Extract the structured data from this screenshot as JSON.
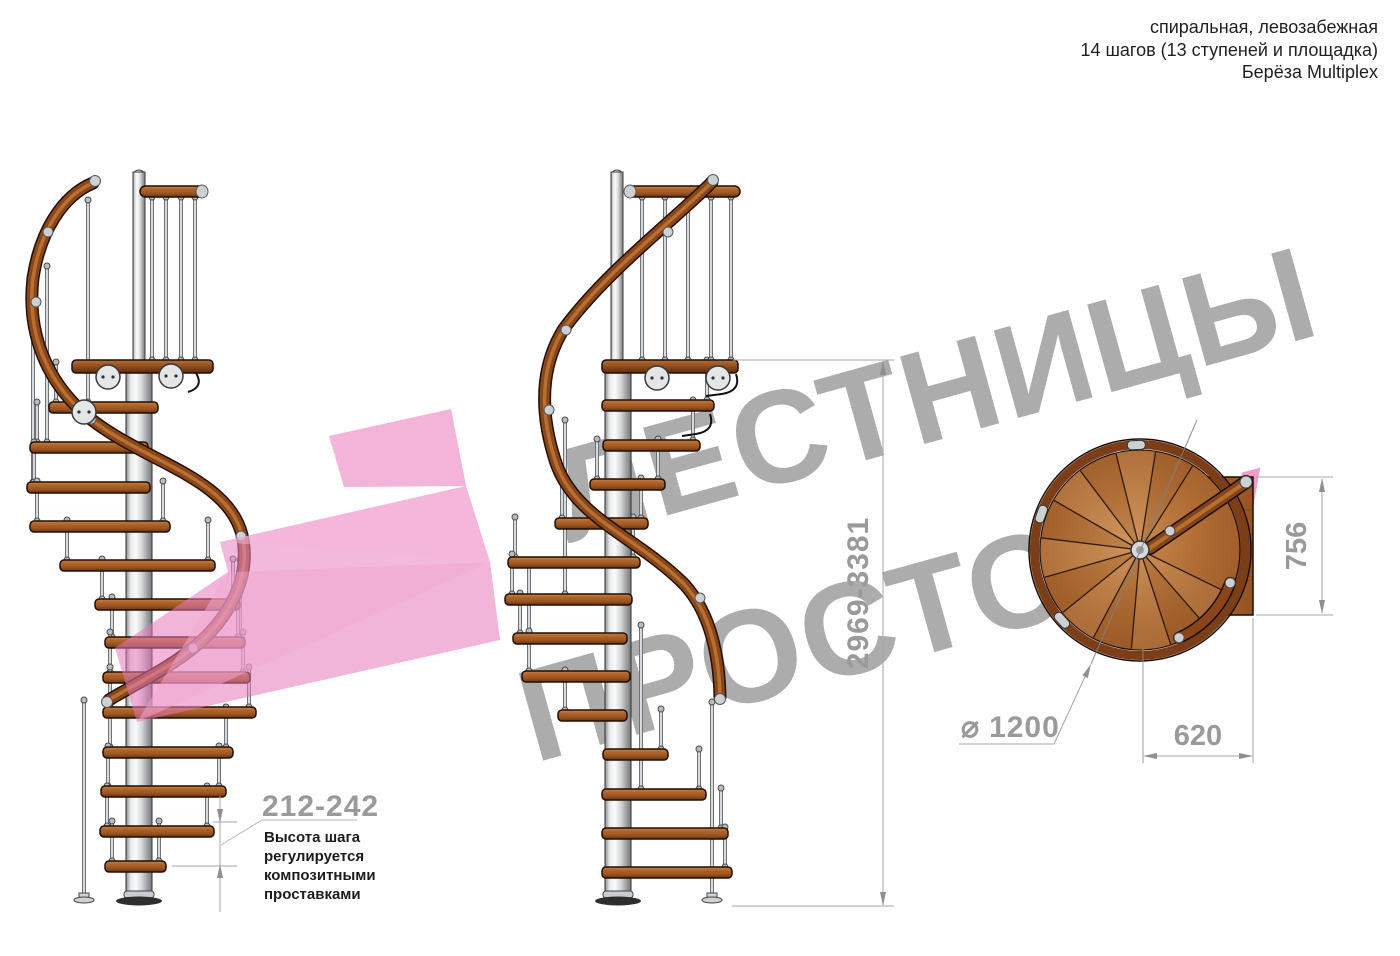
{
  "header": {
    "line1": "спиральная, левозабежная",
    "line2": "14 шагов (13 ступеней и площадка)",
    "line3": "Берёза Multiplex"
  },
  "watermark": {
    "line1": "ЛЕСТНИЦЫ",
    "line2": "ПРОСТО",
    "line2_accent": ".РУ"
  },
  "dimensions": {
    "total_height": "2969-3381",
    "platform_depth": "756",
    "platform_width": "620",
    "diameter_symbol": "⌀",
    "diameter": "1200",
    "step_height": "212-242"
  },
  "annotation": {
    "lines": [
      "Высота шага",
      "регулируется",
      "композитными",
      "проставками"
    ]
  },
  "icons": {
    "logo": "pink-arrow-logo"
  },
  "colors": {
    "accent_pink": "#ea86c2",
    "accent_pink_light": "#f5b5da",
    "watermark_gray": "#808080",
    "watermark_pink": "#e84a98",
    "wood": "#a5612c",
    "wood_dark": "#6b3310",
    "rail_wood": "#8a4619",
    "metal": "#d9dadc",
    "dim_gray": "#9a9a9a",
    "text_black": "#1c1c1c"
  }
}
